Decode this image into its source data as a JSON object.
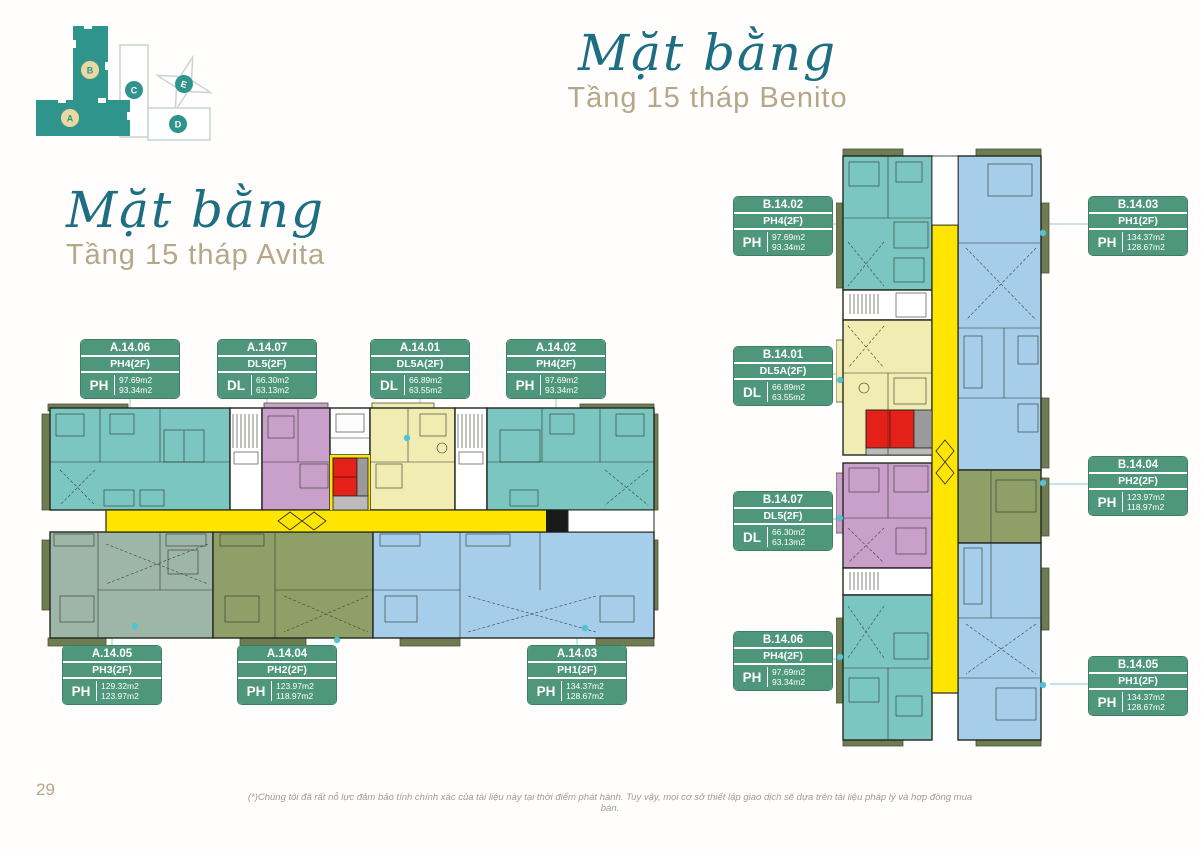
{
  "page": {
    "number": "29",
    "disclaimer": "(*)Chúng tôi đã rất nỗ lực đảm bảo tính chính xác của tài liệu này tại thời điểm phát hành. Tuy vậy, mọi cơ sở thiết lập giao dịch sẽ dựa trên tài liệu pháp lý và hợp đồng mua bán."
  },
  "benito_title": {
    "script": "Mặt bằng",
    "subtitle": "Tầng 15 tháp Benito"
  },
  "avita_title": {
    "script": "Mặt bằng",
    "subtitle": "Tầng 15 tháp Avita"
  },
  "minimap": {
    "blocks": [
      {
        "id": "B",
        "shape": "tower-vertical",
        "highlighted": true
      },
      {
        "id": "C",
        "shape": "tower-vertical",
        "highlighted": false
      },
      {
        "id": "E",
        "shape": "star-tower",
        "highlighted": false
      },
      {
        "id": "A",
        "shape": "tower-horizontal",
        "highlighted": true
      },
      {
        "id": "D",
        "shape": "tower-horizontal",
        "highlighted": false
      }
    ]
  },
  "avita": {
    "units": [
      {
        "code": "A.14.06",
        "type": "PH4(2F)",
        "cat": "PH",
        "area1": "97.69m2",
        "area2": "93.34m2"
      },
      {
        "code": "A.14.07",
        "type": "DL5(2F)",
        "cat": "DL",
        "area1": "66.30m2",
        "area2": "63.13m2"
      },
      {
        "code": "A.14.01",
        "type": "DL5A(2F)",
        "cat": "DL",
        "area1": "66.89m2",
        "area2": "63.55m2"
      },
      {
        "code": "A.14.02",
        "type": "PH4(2F)",
        "cat": "PH",
        "area1": "97.69m2",
        "area2": "93.34m2"
      },
      {
        "code": "A.14.05",
        "type": "PH3(2F)",
        "cat": "PH",
        "area1": "129.32m2",
        "area2": "123.97m2"
      },
      {
        "code": "A.14.04",
        "type": "PH2(2F)",
        "cat": "PH",
        "area1": "123.97m2",
        "area2": "118.97m2"
      },
      {
        "code": "A.14.03",
        "type": "PH1(2F)",
        "cat": "PH",
        "area1": "134.37m2",
        "area2": "128.67m2"
      }
    ]
  },
  "benito": {
    "units": [
      {
        "code": "B.14.02",
        "type": "PH4(2F)",
        "cat": "PH",
        "area1": "97.69m2",
        "area2": "93.34m2"
      },
      {
        "code": "B.14.03",
        "type": "PH1(2F)",
        "cat": "PH",
        "area1": "134.37m2",
        "area2": "128.67m2"
      },
      {
        "code": "B.14.01",
        "type": "DL5A(2F)",
        "cat": "DL",
        "area1": "66.89m2",
        "area2": "63.55m2"
      },
      {
        "code": "B.14.04",
        "type": "PH2(2F)",
        "cat": "PH",
        "area1": "123.97m2",
        "area2": "118.97m2"
      },
      {
        "code": "B.14.07",
        "type": "DL5(2F)",
        "cat": "DL",
        "area1": "66.30m2",
        "area2": "63.13m2"
      },
      {
        "code": "B.14.06",
        "type": "PH4(2F)",
        "cat": "PH",
        "area1": "97.69m2",
        "area2": "93.34m2"
      },
      {
        "code": "B.14.05",
        "type": "PH1(2F)",
        "cat": "PH",
        "area1": "134.37m2",
        "area2": "128.67m2"
      }
    ]
  },
  "colors": {
    "accent_teal": "#1e6e83",
    "tan": "#b5a78a",
    "card_green": "#4f977c",
    "corridor_yellow": "#ffe500",
    "unit_teal": "#7cc6c1",
    "unit_pink": "#c9a0c9",
    "unit_pale_yellow": "#f0ecb2",
    "unit_olive": "#8f9f68",
    "unit_sage": "#9eb6a8",
    "unit_blue": "#a6cdea",
    "core_red": "#e32119",
    "balcony_olive": "#6f7b51",
    "minimap_teal": "#2f958c",
    "minimap_badge_yellow": "#e9d9a0"
  }
}
